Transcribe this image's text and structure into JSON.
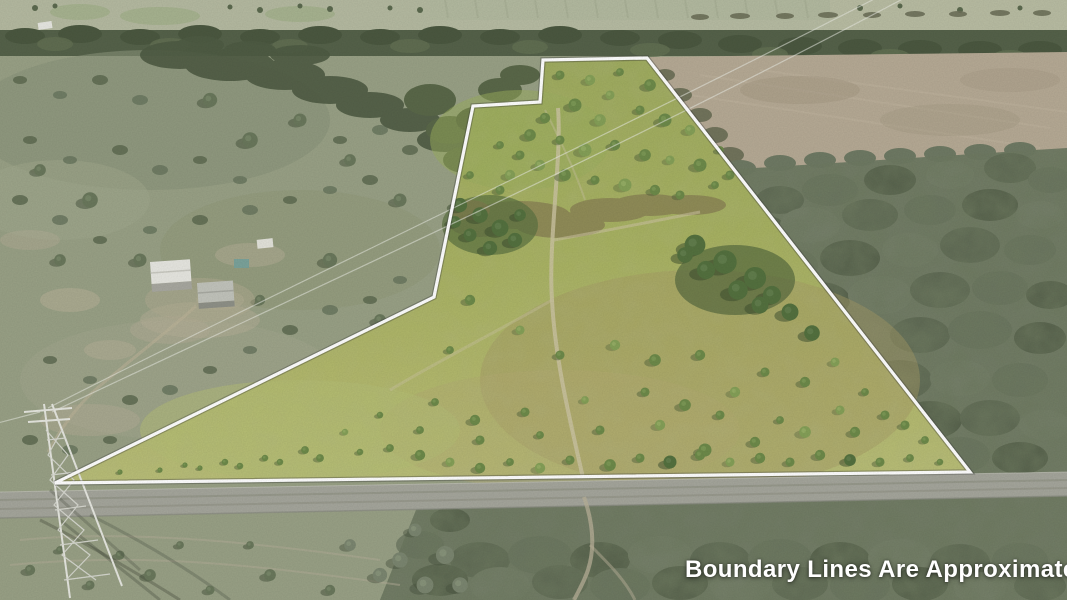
{
  "caption": {
    "text": "Boundary Lines Are Approximate",
    "color": "#ffffff"
  },
  "boundary": {
    "points": "543,60 647,58 970,472 55,483 434,297 473,106 540,102",
    "stroke": "#ffffff"
  },
  "palette": {
    "property_grass_green": "#aab465",
    "outside_scrub_gray_green": "#8f977f",
    "plowed_field_tan": "#b6aa95",
    "woods_gray": "#747e68",
    "road_gray": "#a5a69c",
    "boundary_white": "#ffffff"
  }
}
